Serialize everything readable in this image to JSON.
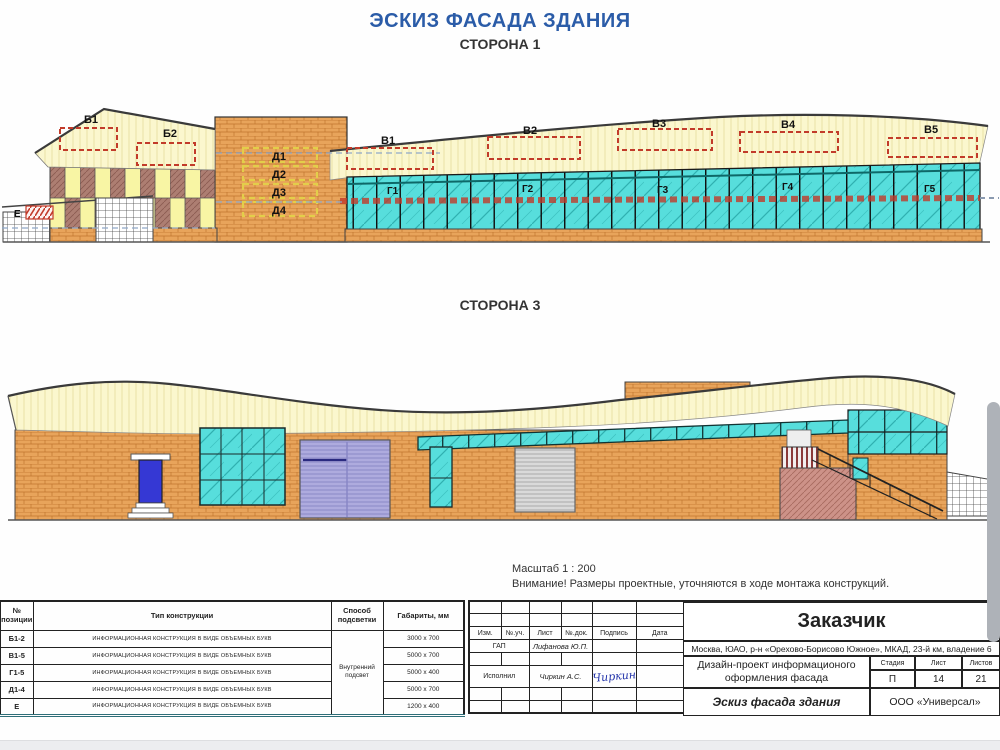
{
  "page": {
    "title": "ЭСКИЗ ФАСАДА ЗДАНИЯ",
    "side1_label": "СТОРОНА 1",
    "side3_label": "СТОРОНА 3",
    "scale_note": "Масштаб 1 : 200",
    "warning_note": "Внимание! Размеры проектные, уточняются в ходе монтажа конструкций."
  },
  "side1": {
    "signs": {
      "b": [
        "Б1",
        "Б2"
      ],
      "v": [
        "В1",
        "В2",
        "В3",
        "В4",
        "В5"
      ],
      "g": [
        "Г1",
        "Г2",
        "Г3",
        "Г4",
        "Г5"
      ],
      "d": [
        "Д1",
        "Д2",
        "Д3",
        "Д4"
      ],
      "e": "Е"
    }
  },
  "spec_table": {
    "headers": {
      "pos": "№ позиции",
      "type": "Тип конструкции",
      "light": "Способ подсветки",
      "size": "Габариты, мм"
    },
    "lighting": "Внутренний подсвет",
    "rows": [
      {
        "pos": "Б1-2",
        "type": "ИНФОРМАЦИОННАЯ КОНСТРУКЦИЯ В ВИДЕ ОБЪЕМНЫХ БУКВ",
        "size": "3000 x 700"
      },
      {
        "pos": "В1-5",
        "type": "ИНФОРМАЦИОННАЯ КОНСТРУКЦИЯ В ВИДЕ ОБЪЕМНЫХ БУКВ",
        "size": "5000 x 700"
      },
      {
        "pos": "Г1-5",
        "type": "ИНФОРМАЦИОННАЯ КОНСТРУКЦИЯ В ВИДЕ ОБЪЕМНЫХ БУКВ",
        "size": "5000 x 400"
      },
      {
        "pos": "Д1-4",
        "type": "ИНФОРМАЦИОННАЯ КОНСТРУКЦИЯ В ВИДЕ ОБЪЕМНЫХ БУКВ",
        "size": "5000 x 700"
      },
      {
        "pos": "Е",
        "type": "ИНФОРМАЦИОННАЯ КОНСТРУКЦИЯ В ВИДЕ ОБЪЕМНЫХ БУКВ",
        "size": "1200 x 400"
      }
    ]
  },
  "stamp": {
    "cols": [
      "Изм.",
      "№.уч.",
      "Лист",
      "№.док.",
      "Подпись",
      "Дата"
    ],
    "rows": [
      {
        "role": "ГАП",
        "name": "Лифанова Ю.П.",
        "signature": ""
      },
      {
        "role": "Исполнил",
        "name": "Чиркин А.С.",
        "signature": "Чиркин"
      }
    ]
  },
  "title_block": {
    "customer_label": "Заказчик",
    "address": "Москва, ЮАО, р-н «Орехово-Борисово Южное», МКАД, 23-й км, владение 6",
    "project": "Дизайн-проект информационого оформления фасада",
    "stage_label": "Стадия",
    "sheet_label": "Лист",
    "sheets_label": "Листов",
    "stage": "П",
    "sheet": "14",
    "sheets": "21",
    "doc_name": "Эскиз фасада здания",
    "company": "ООО «Универсал»"
  },
  "colors": {
    "title_blue": "#2b5ca8",
    "brick": "#e8a45b",
    "canopy": "#fbf7ce",
    "glass": "#57dedc",
    "sign_dash_red": "#c23b2a",
    "checker_brown": "#ad7e72",
    "panel_yellow": "#f8f5a4",
    "door_blue": "#3538d4",
    "gate_lavender": "#aeabde",
    "gate_gray": "#dadada"
  }
}
